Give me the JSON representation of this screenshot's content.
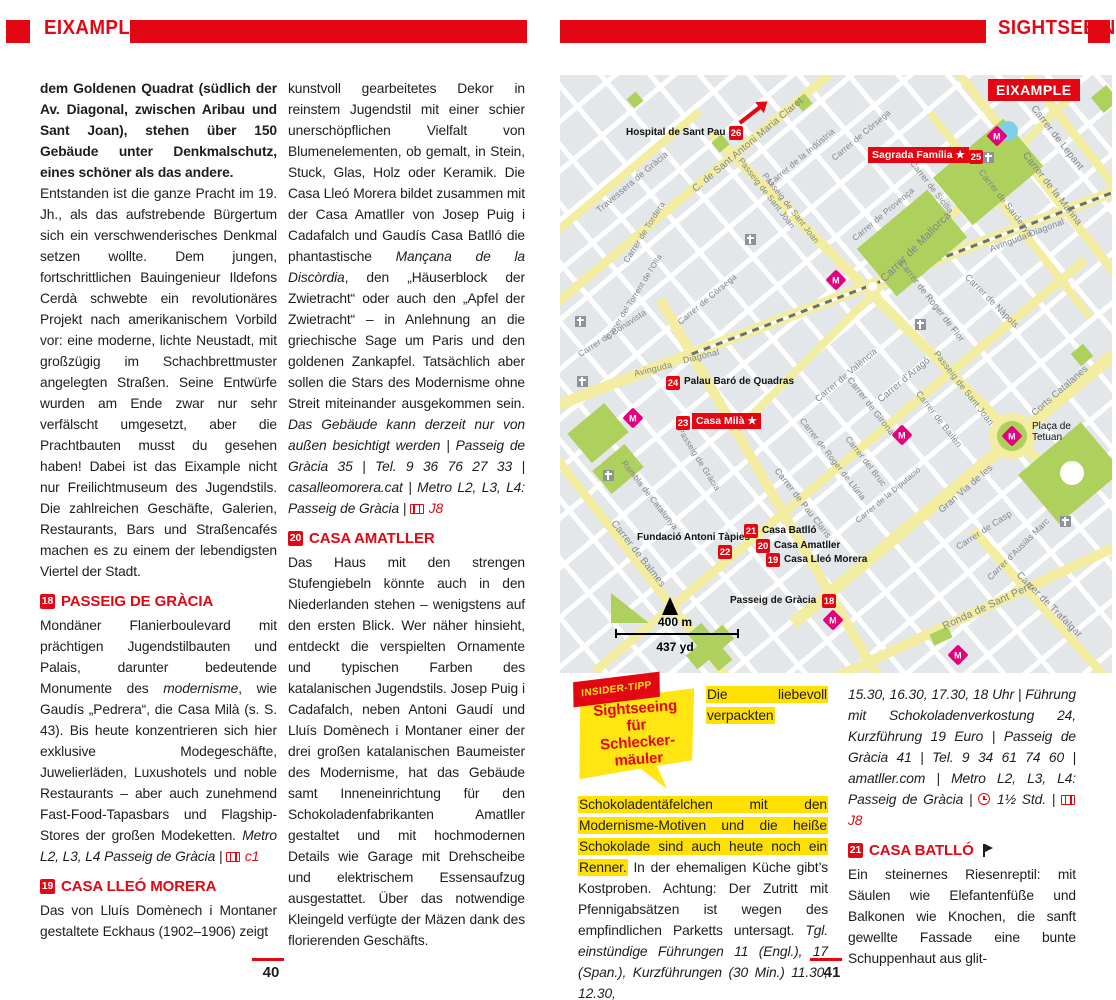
{
  "header": {
    "left_title": "EIXAMPLE",
    "right_title": "SIGHTSEEING"
  },
  "colors": {
    "accent": "#e30613",
    "map_bg": "#e4e7e9",
    "street_yellow": "#f3eda1",
    "park_green": "#aed05c",
    "water_blue": "#7fd0e4",
    "metro_magenta": "#e6007e",
    "highlight_yellow": "#ffe000",
    "bubble_yellow": "#ffe512"
  },
  "page_numbers": {
    "left": "40",
    "right": "41"
  },
  "columns": {
    "col1": [
      {
        "p": [
          {
            "t": "dem Goldenen Quadrat (südlich der Av. Diagonal, zwischen Aribau und Sant Joan), stehen über 150 Gebäude unter Denkmalschutz, eines schöner als das andere.",
            "b": 1
          }
        ]
      },
      {
        "p": [
          {
            "t": "Entstanden ist die ganze Pracht im 19. Jh., als das aufstrebende Bürgertum sich ein verschwenderisches Denkmal setzen wollte. Dem jungen, fortschrittlichen Bauingenieur Ildefons Cerdà schwebte ein revolutionäres Projekt nach amerikanischem Vorbild vor: eine moderne, lichte Neustadt, mit großzügig im Schachbrettmuster angelegten Straßen. Seine Entwürfe wurden am Ende zwar nur sehr verfälscht umgesetzt, aber die Prachtbauten musst du gesehen haben! Dabei ist das Eixample nicht nur Freilichtmuseum des Jugendstils. Die zahlreichen Geschäfte, Galerien, Restaurants, Bars und Straßencafés machen es zu einem der lebendigsten Viertel der Stadt."
          }
        ]
      },
      {
        "h": {
          "num": "18",
          "t": "PASSEIG DE GRÀCIA"
        }
      },
      {
        "p": [
          {
            "t": "Mondäner Flanierboulevard mit prächtigen Jugendstilbauten und Palais, darunter bedeutende Monumente des "
          },
          {
            "t": "modernisme",
            "i": 1
          },
          {
            "t": ", wie Gaudís „Pedrera“, die Casa Milà (s. S. 43). Bis heute konzentrieren sich hier exklusive Modegeschäfte, Juwelierläden, Luxushotels und noble Restaurants – aber auch zunehmend Fast-Food-Tapasbars und Flagship-Stores der großen Modeketten. "
          },
          {
            "t": "Metro L2, L3, L4 Passeig de Gràcia | ",
            "i": 1
          },
          {
            "ic": "map"
          },
          {
            "t": " c1",
            "i": 1,
            "red": 1
          }
        ]
      },
      {
        "h": {
          "num": "19",
          "t": "CASA LLEÓ MORERA"
        }
      },
      {
        "p": [
          {
            "t": "Das von Lluís Domènech i Montaner gestaltete Eckhaus (1902–1906) zeigt"
          }
        ]
      }
    ],
    "col2": [
      {
        "p": [
          {
            "t": "kunstvoll gearbeitetes Dekor in reinstem Jugendstil mit einer schier unerschöpflichen Vielfalt von Blumenelementen, ob gemalt, in Stein, Stuck, Glas, Holz oder Keramik. Die Casa Lleó Morera bildet zusammen mit der Casa Amatller von Josep Puig i Cadafalch und Gaudís Casa Batlló die phantastische "
          },
          {
            "t": "Mançana de la Discòrdia",
            "i": 1
          },
          {
            "t": ", den „Häuserblock der Zwietracht“ oder auch den „Apfel der Zwietracht“ – in Anlehnung an die griechische Sage um Paris und den goldenen Zankapfel. Tatsächlich aber sollen die Stars des Modernisme ohne Streit miteinander ausgekommen sein. "
          },
          {
            "t": "Das Gebäude kann derzeit nur von außen besichtigt werden | Passeig de Gràcia 35 | Tel. 9 36 76 27 33 | casalleomorera.cat | Metro L2, L3, L4: Passeig de Gràcia | ",
            "i": 1
          },
          {
            "ic": "map"
          },
          {
            "t": " J8",
            "i": 1,
            "red": 1
          }
        ]
      },
      {
        "h": {
          "num": "20",
          "t": "CASA AMATLLER"
        }
      },
      {
        "p": [
          {
            "t": "Das Haus mit den strengen Stufengiebeln könnte auch in den Niederlanden stehen – wenigstens auf den ersten Blick. Wer näher hinsieht, entdeckt die verspielten Ornamente und typischen Farben des katalanischen Jugendstils. Josep Puig i Cadafalch, neben Antoni Gaudí und Lluís Domènech i Montaner einer der drei großen katalanischen Baumeister des Modernisme, hat das Gebäude samt Inneneinrichtung für den Schokoladenfabrikanten Amatller gestaltet und mit hochmodernen Details wie Garage mit Drehscheibe und elektrischem Essensaufzug ausgestattet. Über das notwendige Kleingeld verfügte der Mäzen dank des florierenden Geschäfts."
          }
        ]
      }
    ],
    "col3": [
      {
        "insider": {
          "ribbon": "INSIDER-TIPP",
          "lines": [
            "Sightseeing",
            "für",
            "Schlecker-",
            "mäuler"
          ]
        },
        "p": [
          {
            "t": "Die liebevoll verpackten Schokoladentäfelchen mit den Modernisme-Motiven und die heiße Schokolade sind auch heute noch ein Renner.",
            "hl": 1
          },
          {
            "t": " In der ehemaligen Küche gibt’s Kostproben. Achtung: Der Zutritt mit Pfennigabsätzen ist wegen des empfindlichen Parketts untersagt. "
          },
          {
            "t": "Tgl. einstündige Führungen 11 (Engl.), 17 (Span.), Kurzführungen (30 Min.) 11.30, 12.30,",
            "i": 1
          }
        ]
      }
    ],
    "col4": [
      {
        "p": [
          {
            "t": "15.30, 16.30, 17.30, 18 Uhr | Führung mit Schokoladenverkostung 24, Kurzführung 19 Euro | Passeig de Gràcia 41 | Tel. 9 34 61 74 60 | amatller.com | Metro L2, L3, L4: Passeig de Gràcia | ",
            "i": 1
          },
          {
            "ic": "clock"
          },
          {
            "t": " 1½ Std. | ",
            "i": 1
          },
          {
            "ic": "map"
          },
          {
            "t": " J8",
            "i": 1,
            "red": 1
          }
        ]
      },
      {
        "h": {
          "num": "21",
          "t": "CASA BATLLÓ",
          "flag": true
        }
      },
      {
        "p": [
          {
            "t": "Ein steinernes Riesenreptil: mit Säulen wie Elefantenfüße und Balkonen wie Knochen, die sanft gewellte Fassade eine bunte Schuppenhaut aus glit-"
          }
        ]
      }
    ]
  },
  "map": {
    "region_label": "EIXAMPLE",
    "scale": {
      "m": "400 m",
      "yd": "437 yd"
    },
    "yellow_streets": [
      {
        "x": 175,
        "y": 78,
        "l": 480,
        "w": 9,
        "r": -40
      },
      {
        "x": 40,
        "y": 120,
        "l": 260,
        "w": 8,
        "r": -40
      },
      {
        "x": 354,
        "y": 178,
        "l": 460,
        "w": 8,
        "r": -45
      },
      {
        "x": 280,
        "y": 390,
        "l": 640,
        "w": 9,
        "r": -40
      },
      {
        "x": 440,
        "y": 375,
        "l": 540,
        "w": 12,
        "r": -40
      },
      {
        "x": 420,
        "y": 535,
        "l": 340,
        "w": 10,
        "r": -25
      },
      {
        "x": 270,
        "y": 225,
        "l": 650,
        "w": 11,
        "r": -21
      },
      {
        "x": 80,
        "y": 490,
        "l": 380,
        "w": 9,
        "r": 52
      },
      {
        "x": 210,
        "y": 415,
        "l": 440,
        "w": 10,
        "r": 60
      },
      {
        "x": 335,
        "y": 242,
        "l": 520,
        "w": 10,
        "r": 45
      },
      {
        "x": 490,
        "y": 115,
        "l": 320,
        "w": 9,
        "r": 52
      },
      {
        "x": 515,
        "y": 60,
        "l": 230,
        "w": 9,
        "r": 52
      },
      {
        "x": 450,
        "y": 140,
        "l": 260,
        "w": 8,
        "r": 52
      },
      {
        "x": 490,
        "y": 540,
        "l": 230,
        "w": 9,
        "r": 48
      }
    ],
    "railway": {
      "x": 365,
      "y": 188,
      "l": 500,
      "r": -21
    },
    "parks": [
      {
        "x": 428,
        "y": 97,
        "w": 92,
        "h": 62,
        "r": -40
      },
      {
        "x": 352,
        "y": 168,
        "w": 92,
        "h": 62,
        "r": -40
      },
      {
        "x": 510,
        "y": 398,
        "w": 82,
        "h": 64,
        "r": -40
      },
      {
        "x": 38,
        "y": 358,
        "w": 48,
        "h": 38,
        "r": -40
      },
      {
        "x": 58,
        "y": 394,
        "w": 42,
        "h": 30,
        "r": -40
      },
      {
        "x": 150,
        "y": 572,
        "w": 48,
        "h": 18,
        "r": -40
      },
      {
        "x": 150,
        "y": 572,
        "w": 18,
        "h": 48,
        "r": -40
      },
      {
        "x": 160,
        "y": 68,
        "w": 13,
        "h": 13,
        "r": -40
      },
      {
        "x": 545,
        "y": 24,
        "w": 20,
        "h": 20,
        "r": -40
      },
      {
        "x": 522,
        "y": 280,
        "w": 16,
        "h": 16,
        "r": -40
      },
      {
        "x": 243,
        "y": 27,
        "w": 13,
        "h": 13,
        "r": -40
      },
      {
        "x": 75,
        "y": 25,
        "w": 12,
        "h": 12,
        "r": -40
      },
      {
        "x": 381,
        "y": 561,
        "w": 20,
        "h": 12,
        "r": -25
      },
      {
        "x": 70,
        "y": 533,
        "w": 38,
        "h": 30,
        "r": 0,
        "tri": 1
      }
    ],
    "circles": [
      {
        "x": 452,
        "y": 361,
        "d": 46,
        "fill": "#f3eda1"
      },
      {
        "x": 452,
        "y": 361,
        "d": 30,
        "fill": "#aed05c"
      },
      {
        "x": 512,
        "y": 398,
        "d": 24,
        "fill": "#ffffff"
      },
      {
        "x": 448,
        "y": 56,
        "d": 20,
        "fill": "#7fd0e4"
      },
      {
        "x": 312,
        "y": 211,
        "d": 13,
        "fill": "#ffffff",
        "stroke": "#f3eda1"
      },
      {
        "x": 231,
        "y": 137,
        "d": 12,
        "fill": "#ffffff",
        "stroke": "#f3eda1"
      }
    ],
    "metro_stations": [
      {
        "x": 437,
        "y": 61
      },
      {
        "x": 276,
        "y": 205
      },
      {
        "x": 73,
        "y": 343
      },
      {
        "x": 342,
        "y": 360
      },
      {
        "x": 452,
        "y": 361
      },
      {
        "x": 273,
        "y": 545
      },
      {
        "x": 398,
        "y": 580
      }
    ],
    "churches": [
      {
        "x": 190,
        "y": 164
      },
      {
        "x": 20,
        "y": 246
      },
      {
        "x": 22,
        "y": 306
      },
      {
        "x": 360,
        "y": 249
      },
      {
        "x": 505,
        "y": 446
      },
      {
        "x": 48,
        "y": 400
      },
      {
        "x": 428,
        "y": 82
      }
    ],
    "street_labels": [
      {
        "t": "Travessera de Gràcia",
        "x": 72,
        "y": 107,
        "r": -40,
        "s": 9
      },
      {
        "t": "Carrer de Tordera",
        "x": 84,
        "y": 157,
        "r": -58,
        "s": 8.5
      },
      {
        "t": "Carrer del Torrent de l'Olla",
        "x": 74,
        "y": 222,
        "r": -58,
        "s": 8
      },
      {
        "t": "Carrer de Bonavista",
        "x": 52,
        "y": 258,
        "r": -33,
        "s": 8.5
      },
      {
        "t": "C. de Sant Antoni Maria Claret",
        "x": 188,
        "y": 70,
        "r": -40,
        "s": 10
      },
      {
        "t": "Carrer de la Indústria",
        "x": 241,
        "y": 82,
        "r": -40,
        "s": 8.5
      },
      {
        "t": "Carrer de Còrsega",
        "x": 147,
        "y": 224,
        "r": -40,
        "s": 8.5
      },
      {
        "t": "Carrer de Còrsega",
        "x": 301,
        "y": 60,
        "r": -40,
        "s": 8.5
      },
      {
        "t": "Passeig de Sant Joan",
        "x": 207,
        "y": 118,
        "r": 52,
        "s": 8.5
      },
      {
        "t": "Passeig de Sant Joan",
        "x": 231,
        "y": 133,
        "r": 52,
        "s": 8.5
      },
      {
        "t": "Carrer de Lepant",
        "x": 497,
        "y": 63,
        "r": 52,
        "s": 10
      },
      {
        "t": "Carrer de la Marina",
        "x": 492,
        "y": 114,
        "r": 52,
        "s": 10
      },
      {
        "t": "Carrer de Sardenya",
        "x": 446,
        "y": 128,
        "r": 52,
        "s": 9
      },
      {
        "t": "Carrer de Sicília",
        "x": 372,
        "y": 112,
        "r": 52,
        "s": 8.5
      },
      {
        "t": "Carrer de Provença",
        "x": 323,
        "y": 139,
        "r": -40,
        "s": 8.5
      },
      {
        "t": "Carrer de Mallorca",
        "x": 356,
        "y": 172,
        "r": -45,
        "s": 11
      },
      {
        "t": "Avinguda",
        "x": 93,
        "y": 294,
        "r": -14,
        "s": 9
      },
      {
        "t": "Diagonal",
        "x": 141,
        "y": 281,
        "r": -14,
        "s": 9
      },
      {
        "t": "Avinguda  Diagonal",
        "x": 467,
        "y": 160,
        "r": -21,
        "s": 9
      },
      {
        "t": "Carrer de València",
        "x": 286,
        "y": 300,
        "r": -40,
        "s": 9
      },
      {
        "t": "Carrer d'Aragó",
        "x": 344,
        "y": 305,
        "r": -40,
        "s": 9.5
      },
      {
        "t": "Carrer de Girona",
        "x": 311,
        "y": 331,
        "r": 52,
        "s": 9
      },
      {
        "t": "Carrer de Roger de Flor",
        "x": 372,
        "y": 226,
        "r": 52,
        "s": 9
      },
      {
        "t": "Carrer de Nàpols",
        "x": 432,
        "y": 226,
        "r": 45,
        "s": 9
      },
      {
        "t": "Passeig de Sant Joan",
        "x": 404,
        "y": 313,
        "r": 52,
        "s": 9
      },
      {
        "t": "Carrer de Bailèn",
        "x": 379,
        "y": 344,
        "r": 52,
        "s": 9
      },
      {
        "t": "Carrer del Bruc",
        "x": 306,
        "y": 386,
        "r": 52,
        "s": 8.5
      },
      {
        "t": "Carrer de Pau Claris",
        "x": 243,
        "y": 428,
        "r": 52,
        "s": 9
      },
      {
        "t": "Carrer de Roger de Llúria",
        "x": 273,
        "y": 384,
        "r": 52,
        "s": 8.5
      },
      {
        "t": "Carrer de Balmes",
        "x": 78,
        "y": 479,
        "r": 52,
        "s": 10
      },
      {
        "t": "Rambla de Catalunya",
        "x": 90,
        "y": 420,
        "r": 52,
        "s": 8.5
      },
      {
        "t": "Passeig de Gràcia",
        "x": 139,
        "y": 384,
        "r": 58,
        "s": 8.5
      },
      {
        "t": "Carrer de la Diputació",
        "x": 328,
        "y": 420,
        "r": -40,
        "s": 8
      },
      {
        "t": "Carrer de Casp",
        "x": 424,
        "y": 455,
        "r": -33,
        "s": 9
      },
      {
        "t": "Carrer d'Ausiàs Marc",
        "x": 458,
        "y": 474,
        "r": -45,
        "s": 8.5
      },
      {
        "t": "Ronda de Sant Pere",
        "x": 428,
        "y": 531,
        "r": -25,
        "s": 10.5
      },
      {
        "t": "Carrer de Trafalgar",
        "x": 489,
        "y": 530,
        "r": 45,
        "s": 10
      },
      {
        "t": "Gran Via de les",
        "x": 406,
        "y": 414,
        "r": -41,
        "s": 9.5
      },
      {
        "t": "Corts Catalanes",
        "x": 500,
        "y": 316,
        "r": -41,
        "s": 9.5
      }
    ],
    "badges": [
      {
        "n": "26",
        "x": 169,
        "y": 51
      },
      {
        "n": "25",
        "x": 409,
        "y": 75
      },
      {
        "n": "24",
        "x": 106,
        "y": 301
      },
      {
        "n": "23",
        "x": 116,
        "y": 341
      },
      {
        "n": "22",
        "x": 158,
        "y": 470
      },
      {
        "n": "21",
        "x": 184,
        "y": 449
      },
      {
        "n": "20",
        "x": 196,
        "y": 464
      },
      {
        "n": "19",
        "x": 206,
        "y": 478
      },
      {
        "n": "18",
        "x": 262,
        "y": 519
      }
    ],
    "bold_labels": [
      {
        "t": "Hospital de Sant Pau",
        "x": 66,
        "y": 52
      },
      {
        "t": "Palau Baró de Quadras",
        "x": 124,
        "y": 301
      },
      {
        "t": "Fundació Antoni Tàpies",
        "x": 77,
        "y": 457
      },
      {
        "t": "Casa Batlló",
        "x": 202,
        "y": 450
      },
      {
        "t": "Casa Amatller",
        "x": 214,
        "y": 465
      },
      {
        "t": "Casa Lleó Morera",
        "x": 224,
        "y": 479
      },
      {
        "t": "Passeig de Gràcia",
        "x": 170,
        "y": 520
      }
    ],
    "red_boxes": [
      {
        "t": "Sagrada Família ★",
        "x": 308,
        "y": 72
      },
      {
        "t": "Casa Milà ★",
        "x": 132,
        "y": 338
      }
    ],
    "placa_label": {
      "lines": [
        "Plaça de",
        "Tetuan"
      ],
      "x": 472,
      "y": 346
    }
  }
}
